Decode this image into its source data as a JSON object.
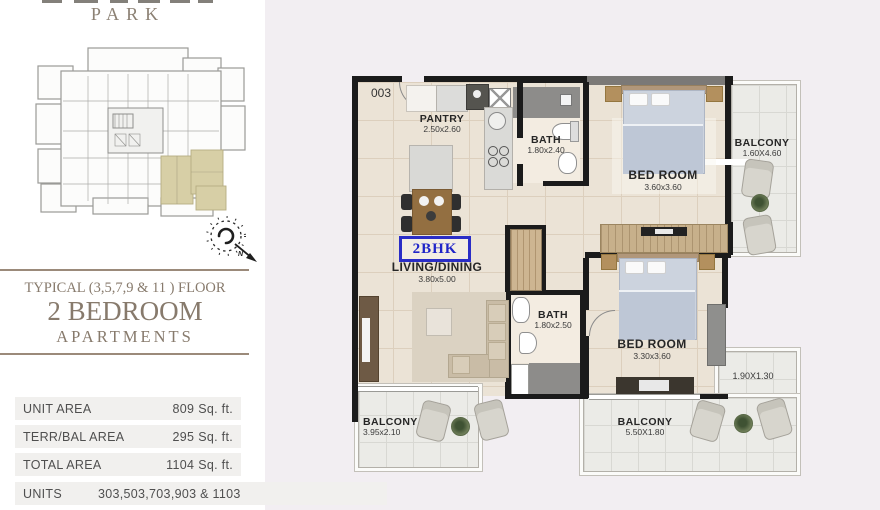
{
  "brand": {
    "logo_text": "PARK"
  },
  "compass": {
    "north_label": "N"
  },
  "left_panel": {
    "floor_line": "TYPICAL (3,5,7,9 & 11 ) FLOOR",
    "title": "2 BEDROOM",
    "subtitle": "APARTMENTS",
    "area_rows": [
      {
        "label": "UNIT AREA",
        "value": "809",
        "unit": "Sq. ft."
      },
      {
        "label": "TERR/BAL AREA",
        "value": "295",
        "unit": "Sq. ft."
      },
      {
        "label": "TOTAL AREA",
        "value": "1104",
        "unit": "Sq. ft."
      },
      {
        "label": "UNITS",
        "value": "303,503,703,903 & 1103",
        "unit": ""
      }
    ]
  },
  "plan": {
    "unit_number": "003",
    "unit_type_badge": "2BHK",
    "rooms": [
      {
        "name": "PANTRY",
        "dims": "2.50x2.60"
      },
      {
        "name": "BATH",
        "dims": "1.80x2.40"
      },
      {
        "name": "BED ROOM",
        "dims": "3.60x3.60"
      },
      {
        "name": "BALCONY",
        "dims": "1.60X4.60"
      },
      {
        "name": "LIVING/DINING",
        "dims": "3.80x5.00"
      },
      {
        "name": "BATH",
        "dims": "1.80x2.50"
      },
      {
        "name": "BED ROOM",
        "dims": "3.30x3.60"
      },
      {
        "name": "BALCONY",
        "dims": "3.95x2.10"
      },
      {
        "name": "BALCONY",
        "dims": "5.50X1.80"
      },
      {
        "name": "",
        "dims": "1.90X1.30"
      }
    ],
    "colors": {
      "badge_blue": "#2a2dc6",
      "wall": "#1b1b1b",
      "floor_beige": "#ebe3d6",
      "balcony_gray": "#ebebe7",
      "keyplan_highlight": "#d7cfa6",
      "heading_taupe": "#877a6c",
      "panel_lavender": "#f2eef2"
    }
  }
}
